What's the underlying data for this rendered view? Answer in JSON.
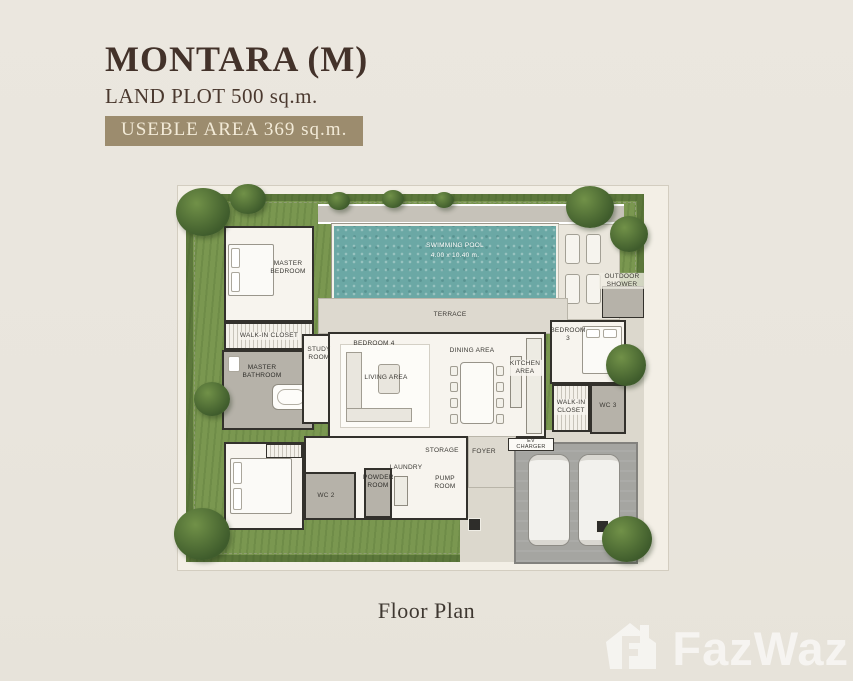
{
  "header": {
    "title": "MONTARA (M)",
    "subtitle": "LAND PLOT 500 sq.m.",
    "badge": "USEBLE AREA 369 sq.m."
  },
  "plan": {
    "pool": {
      "name": "SWIMMING POOL",
      "size": "4.00 x 10.40 m."
    },
    "rooms": {
      "master_bedroom": "MASTER BEDROOM",
      "walk_in_closet": "WALK-IN CLOSET",
      "master_bathroom": "MASTER BATHROOM",
      "study_room": "STUDY ROOM",
      "bedroom_4": "BEDROOM 4",
      "living_area": "LIVING AREA",
      "dining_area": "DINING AREA",
      "kitchen_area": "KITCHEN AREA",
      "terrace": "TERRACE",
      "outdoor_shower": "OUTDOOR SHOWER",
      "bedroom_3": "BEDROOM 3",
      "walk_in_closet_2": "WALK-IN CLOSET",
      "wc_3": "WC 3",
      "wc_2": "WC 2",
      "powder_room": "POWDER ROOM",
      "laundry": "LAUNDRY",
      "storage": "STORAGE",
      "pump_room": "PUMP ROOM",
      "foyer": "FOYER",
      "ev_charger": "EV CHARGER"
    }
  },
  "caption": "Floor Plan",
  "watermark": "FazWaz",
  "colors": {
    "background": "#e9e5dd",
    "title_text": "#43322a",
    "badge_bg": "#9c8c6e",
    "badge_text": "#f2ead7",
    "grass": "#7a9750",
    "pool_water": "#6ba8a5",
    "wall": "#33312c"
  }
}
